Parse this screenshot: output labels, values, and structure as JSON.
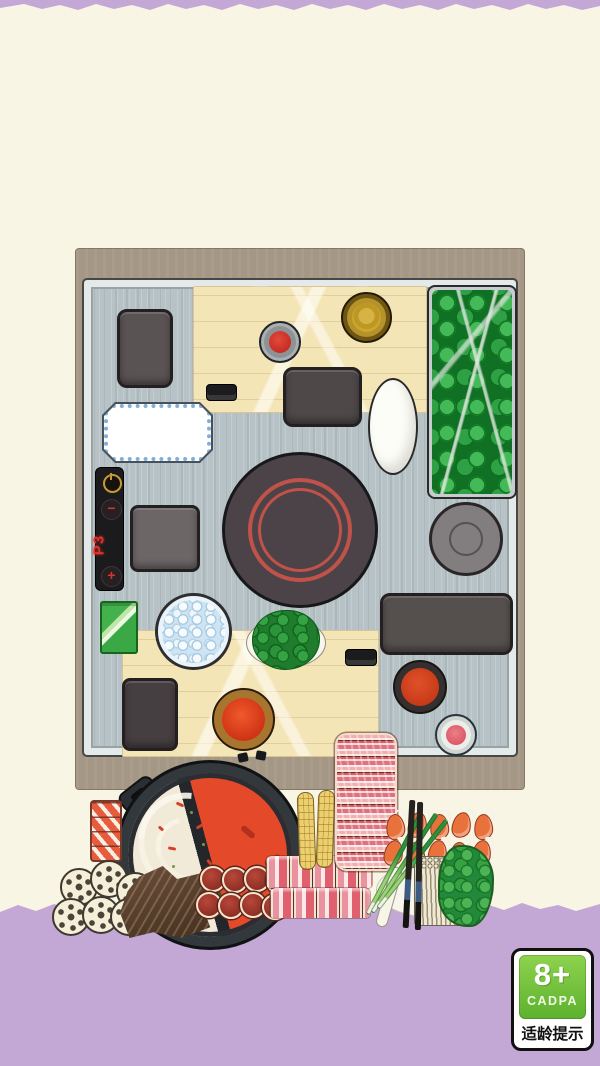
{
  "scene": {
    "background_color": "#f9f5e5",
    "floor_color": "#c3a7d4",
    "table_frame_color": "#a59785",
    "counter_color": "#b6c2c6"
  },
  "stove_panel": {
    "display": "P3",
    "minus_label": "−",
    "plus_label": "+",
    "accent_color": "#e0312b",
    "power_icon": "power-symbol"
  },
  "hotpot": {
    "white_broth_color": "#f1ead8",
    "red_broth_color": "#e4492a"
  },
  "age_badge": {
    "age": "8+",
    "org": "CADPA",
    "caption": "适龄提示",
    "green_color": "#6fc13c"
  },
  "objects": [
    "tray",
    "cutting-board",
    "chili-sauce-bowl",
    "sesame-sauce-bowl",
    "oval-plate",
    "lettuce-tray",
    "dotted-plate",
    "induction-cooker",
    "stove-control-panel",
    "gray-plate",
    "green-napkin",
    "ice-bowl",
    "parsley-plate",
    "pink-sauce-bowl",
    "binder-clip",
    "split-hotpot",
    "salmon-slab",
    "lotus-root-slices",
    "kelp",
    "meatball-skewers",
    "beef-rolls",
    "corn-cobs",
    "beef-roll-stack",
    "shrimp",
    "scallions",
    "chopsticks",
    "enoki-mushrooms",
    "broccoli"
  ]
}
